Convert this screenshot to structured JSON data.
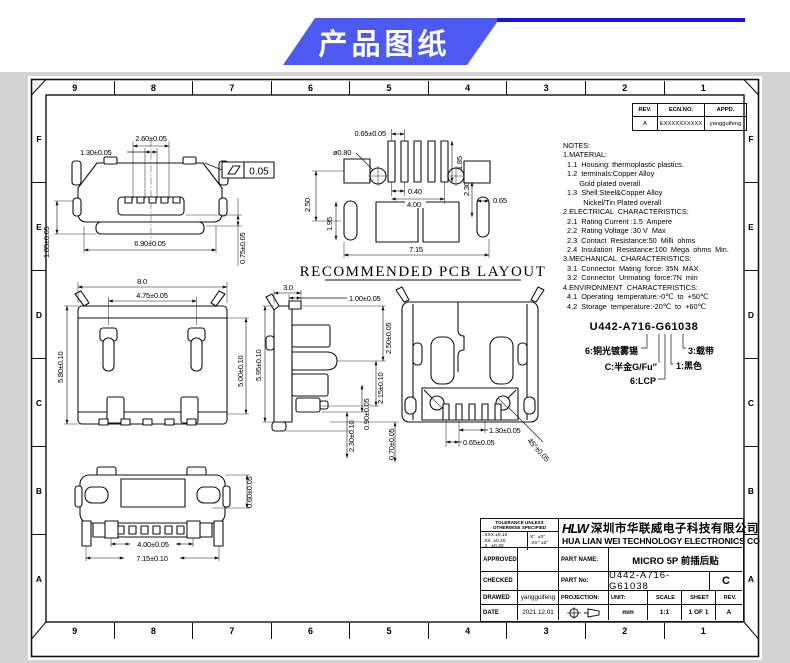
{
  "banner": {
    "title": "产品图纸",
    "accent": "#4c5af2",
    "line_color": "#1414e0"
  },
  "grid": {
    "cols": [
      "9",
      "8",
      "7",
      "6",
      "5",
      "4",
      "3",
      "2",
      "1"
    ],
    "rows": [
      "F",
      "E",
      "D",
      "C",
      "B",
      "A"
    ]
  },
  "rev_table": {
    "rev_h": "REV.",
    "ecn_h": "ECN.NO.",
    "appd_h": "APPD.",
    "rev": "A",
    "ecn": "EXXXXXXXXXX",
    "appd": "yangguifeng"
  },
  "notes": {
    "lines": [
      "NOTES:",
      "1.MATERIAL:",
      "  1.1  Housing: thermoplastic plastics.",
      "  1.2  terminals:Copper Alloy",
      "        Gold plated overall",
      "  1.3  Shell:Steel&Copper Alloy",
      "          Nickel/Tin Plated overall",
      "2.ELECTRICAL  CHARACTERISTICS:",
      "  2.1  Rating Current :1.5  Ampere",
      "  2.2  Rating Voltage :30 V  Max",
      "  2.3  Contact  Resistance:50  Milli  ohms",
      "  2.4  Insulation  Resistance:100  Mega  ohms  Min.",
      "3.MECHANICAL  CHARACTERISTICS:",
      "  3.1  Connector  Mating  force: 35N  MAX",
      "  3.2  Connector  Unmating  force:7N  min",
      "4.ENVIRONMENT  CHARACTERISTICS:",
      "  4.1  Operating  temperature:-0℃  to  +50℃",
      "  4.2  Storage  temperature:-20℃  to  +60℃"
    ]
  },
  "views": {
    "pcb_title": "RECOMMENDED PCB LAYOUT",
    "front": {
      "d_260": "2.60±0.05",
      "d_130": "1.30±0.05",
      "d_690": "6.90±0.05",
      "d_185": "1.85±0.05",
      "d_075": "0.75±0.05",
      "flatness": "0.05"
    },
    "pcb": {
      "d_065t": "0.65±0.05",
      "d_dia": "ø0.80",
      "d_250": "2.50",
      "d_195": "1.95",
      "d_185": "1.85",
      "d_040": "0.40",
      "d_400": "4.00",
      "d_065r": "0.65",
      "d_230": "2.30",
      "d_715": "7.15"
    },
    "top": {
      "d_80": "8.0",
      "d_475": "4.75±0.05",
      "d_580": "5.80±0.10",
      "d_500": "5.00±0.10"
    },
    "side": {
      "d_30": "3.0",
      "d_100": "1.00±0.05",
      "d_595": "5.95±0.10",
      "d_250": "2.50±0.05",
      "d_215": "2.15±0.10",
      "d_090": "0.90±0.05",
      "d_230": "2.30±0.10",
      "d_070": "0.70±0.05"
    },
    "bottom": {
      "d_130": "1.30±0.05",
      "d_065": "0.65±0.05",
      "d_45": "45°±0.05"
    },
    "bfront": {
      "d_400": "4.00±0.05",
      "d_715": "7.15±0.10",
      "d_060": "0.60±0.05"
    }
  },
  "part_code": {
    "code": "U442-A716-G61038",
    "l_plating": "6:铜光镀雾锡",
    "l_gold": "C:半金G/Fu″",
    "l_lcp": "6:LCP",
    "l_tape": "3:载带",
    "l_color": "1:黑色"
  },
  "title_block": {
    "tol_h1": "TOLERANCE UNLESS",
    "tol_h2": "OTHERWISE SPECIFIED",
    "tol_l1": ".XXX ±0.10",
    "tol_l2": ".XX  ±0.20",
    "tol_l3": ".X   ±0.30",
    "tol_a1": "X°  ±3°",
    "tol_a2": ".XX° ±2°",
    "logo": "HLW",
    "company_cn": "深圳市华联威电子科技有限公司",
    "company_en": "HUA LIAN WEI TECHNOLOGY ELECTRONICS CO",
    "approved": "APPROVED",
    "checked": "CHECKED",
    "drawed": "DRAWED",
    "date": "DATE",
    "drawed_by": "yangguifeng",
    "date_value": "2021.12.01",
    "part_name_label": "PART NAME:",
    "part_name": "MICRO 5P 前插后贴",
    "part_no_label": "PART No:",
    "part_no": "U442-A716-G61038",
    "part_no_rev": "C",
    "projection": "PROJECTION:",
    "unit_label": "UNIT:",
    "unit": "mm",
    "scale_label": "SCALE",
    "scale": "1:1",
    "sheet_label": "SHEET",
    "sheet": "1 OF 1",
    "rev_label": "REV.",
    "rev": "A"
  }
}
